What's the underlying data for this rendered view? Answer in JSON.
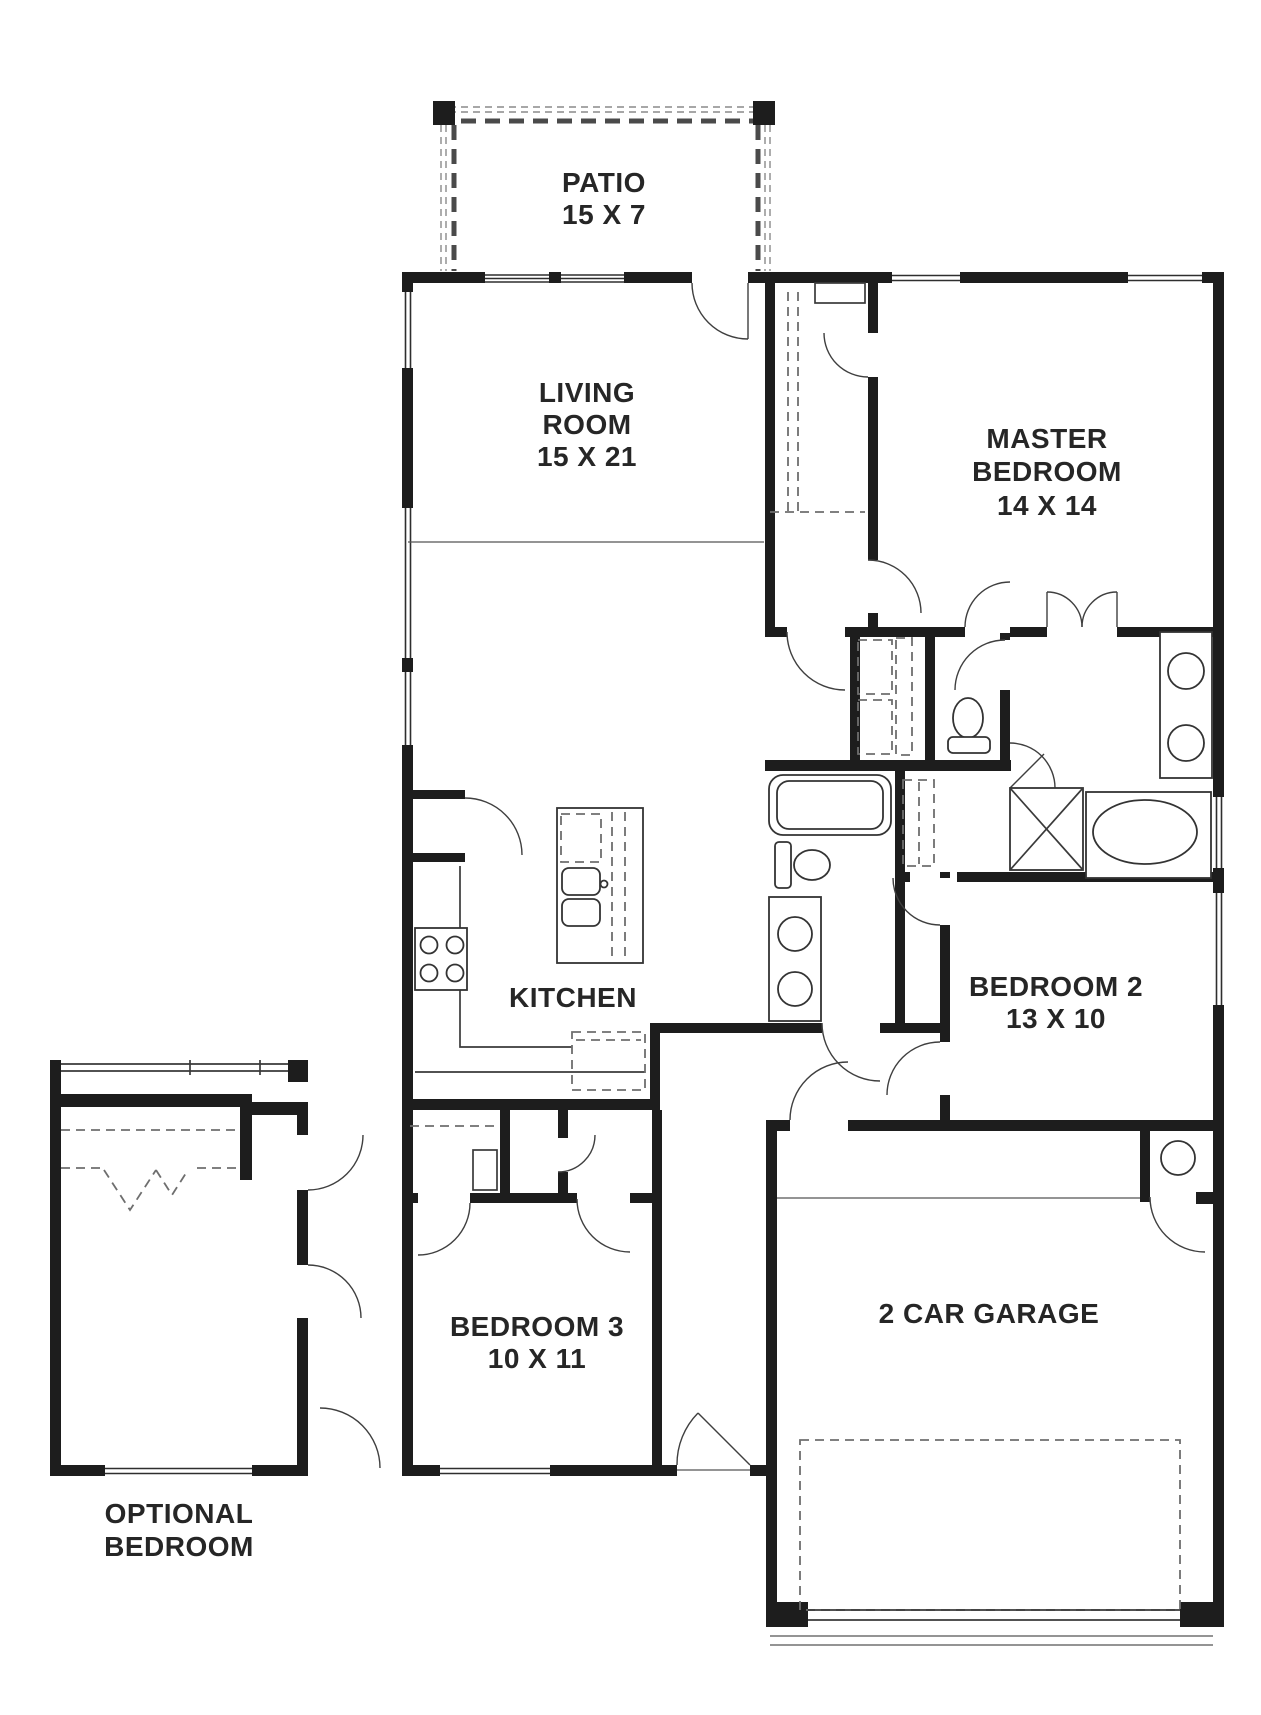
{
  "document": {
    "type": "floor-plan",
    "background": "#ffffff",
    "wall_color": "#1d1d1d",
    "line_color": "#3a3a3a",
    "dash_color": "#6e6e6e",
    "text_color": "#262626"
  },
  "rooms": {
    "patio": {
      "line1": "PATIO",
      "line2": "15 X 7"
    },
    "living": {
      "line1": "LIVING",
      "line2": "ROOM",
      "line3": "15 X 21"
    },
    "master": {
      "line1": "MASTER",
      "line2": "BEDROOM",
      "line3": "14 X 14"
    },
    "kitchen": {
      "line1": "KITCHEN"
    },
    "bedroom2": {
      "line1": "BEDROOM 2",
      "line2": "13 X 10"
    },
    "bedroom3": {
      "line1": "BEDROOM 3",
      "line2": "10 X 11"
    },
    "garage": {
      "line1": "2 CAR GARAGE"
    },
    "optional": {
      "line1": "OPTIONAL",
      "line2": "BEDROOM"
    }
  },
  "fixtures": [
    "kitchen-island-sink",
    "stove-cooktop",
    "refrigerator",
    "pantry",
    "washer-dryer-stack",
    "attic-access",
    "master-toilet",
    "master-double-vanity",
    "shower-stall",
    "garden-tub",
    "hall-bathtub",
    "hall-toilet",
    "hall-vanity",
    "water-heater",
    "garage-door",
    "front-door"
  ]
}
